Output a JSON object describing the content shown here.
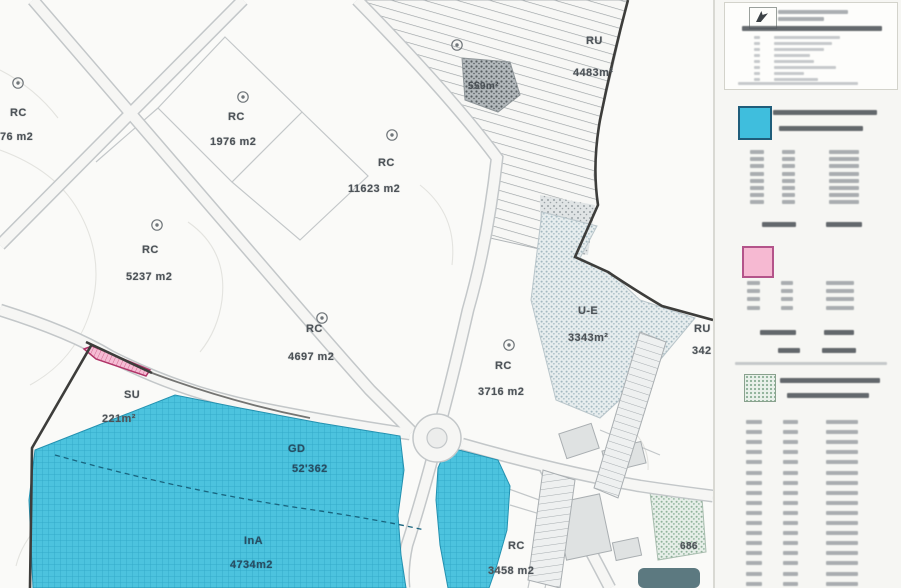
{
  "map": {
    "labels": {
      "rc76": {
        "code": "RC",
        "area": "76 m2"
      },
      "rc1976": {
        "code": "RC",
        "area": "1976 m2"
      },
      "rc5237": {
        "code": "RC",
        "area": "5237 m2"
      },
      "rc11623": {
        "code": "RC",
        "area": "11623 m2"
      },
      "rc4697": {
        "code": "RC",
        "area": "4697 m2"
      },
      "rc3716": {
        "code": "RC",
        "area": "3716 m2"
      },
      "rc3458": {
        "code": "RC",
        "area": "3458 m2"
      },
      "ru4483": {
        "code": "RU",
        "area": "4483m²"
      },
      "p559": {
        "area": "559m²"
      },
      "ue3343": {
        "code": "U-E",
        "area": "3343m²"
      },
      "ru342": {
        "code": "RU",
        "area": "342"
      },
      "su221": {
        "code": "SU",
        "area": "221m²"
      },
      "gd52362": {
        "code": "GD",
        "area": "52'362"
      },
      "ina4734": {
        "code": "InA",
        "area": "4734m2"
      },
      "n686": {
        "area": "686"
      }
    },
    "colors": {
      "cyan_zone": "#4cc3de",
      "cyan_grid": "#2aa3c2",
      "pink_parcel": "#f5bcd4",
      "boundary": "#3d3d3b",
      "teal_patch": "#4a6a72"
    }
  },
  "legend": {
    "swatches": {
      "cyan": {
        "fill": "#3fbedd",
        "border": "#1f5d7a"
      },
      "pink": {
        "fill": "#f6b9d2",
        "border": "#b4548a"
      },
      "green": {
        "fill": "#e9f0ea",
        "border": "#8aa28e"
      }
    },
    "header_box": {
      "top_rows": 3,
      "list_rows": 8
    },
    "cyan_table": {
      "rows": 8,
      "totals": 1
    },
    "pink_table": {
      "rows": 4,
      "totals": 2
    },
    "green_table": {
      "rows": 17,
      "totals": 0
    }
  }
}
